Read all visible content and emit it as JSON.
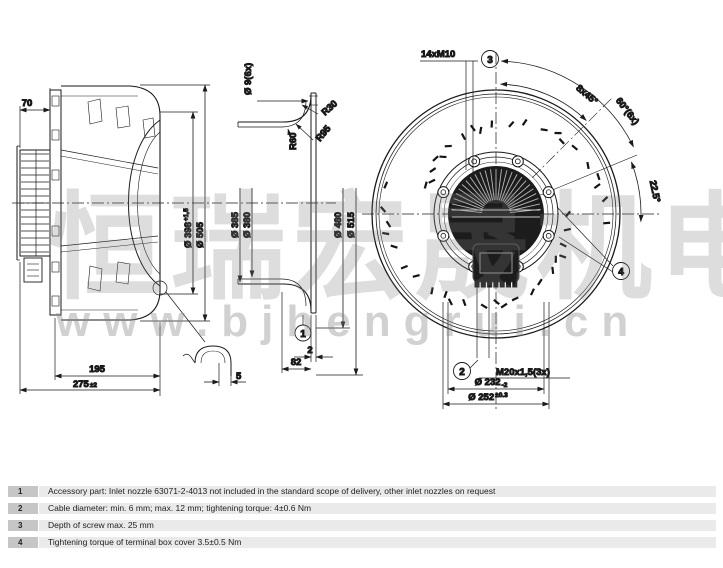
{
  "watermark": {
    "cjk": "恒瑞宏晟机电",
    "url": "www.bjhengrui.cn"
  },
  "left_view": {
    "dim_70": "70",
    "dim_195": "195",
    "dim_275": "275",
    "dim_275_tol": "±2",
    "dia_398": "Ø 398",
    "dia_398_tol": "+1,5",
    "dia_505": "Ø 505",
    "detail_dim_5": "5"
  },
  "nozzle_view": {
    "holes_label": "Ø 9(6x)",
    "r30": "R30",
    "r95": "R95",
    "r60": "R60",
    "dia_385": "Ø 385",
    "dia_380": "Ø 380",
    "dia_480": "Ø 480",
    "dia_515": "Ø 515",
    "note_ref_1": "1",
    "dim_2": "2",
    "dim_82": "82"
  },
  "front_view": {
    "bolt_label": "14xM10",
    "note_ref_3": "3",
    "angle_8x45": "8x45°",
    "angle_60_6x": "60°(6x)",
    "angle_22_5": "22.5°",
    "note_ref_2": "2",
    "gland_label": "M20x1,5(3x)",
    "note_ref_4": "4",
    "dia_232": "Ø 232",
    "dia_232_tol": "-2",
    "dia_252": "Ø 252",
    "dia_252_tol": "±0.3"
  },
  "notes": [
    {
      "num": "1",
      "text": "Accessory part: Inlet nozzle 63071-2-4013 not included in the standard scope of delivery, other inlet nozzles on request"
    },
    {
      "num": "2",
      "text": "Cable diameter: min. 6 mm; max. 12 mm; tightening torque: 4±0.6 Nm"
    },
    {
      "num": "3",
      "text": "Depth of screw max. 25 mm"
    },
    {
      "num": "4",
      "text": "Tightening torque of terminal box cover 3.5±0.5 Nm"
    }
  ]
}
